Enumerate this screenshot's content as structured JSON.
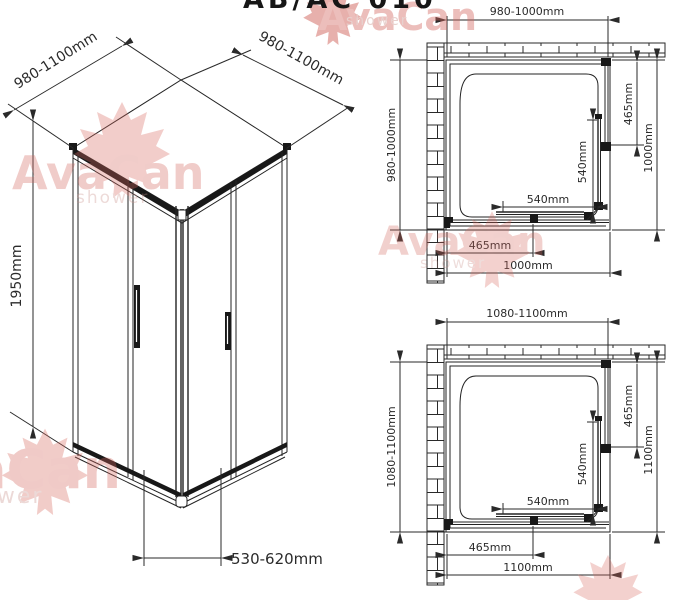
{
  "title_partial": "AB/AC 010",
  "watermark": {
    "brand": "AvaCan",
    "sub": "shower"
  },
  "isometric": {
    "dim_top_left": "980-1100mm",
    "dim_top_right": "980-1100mm",
    "dim_height": "1950mm",
    "dim_entry_width": "530-620mm"
  },
  "plans": [
    {
      "dim_top": "980-1000mm",
      "dim_left": "980-1000mm",
      "dim_right_inner": "465mm",
      "dim_right_outer": "1000mm",
      "dim_inner_vertical": "540mm",
      "dim_inner_horizontal": "540mm",
      "dim_bottom_inner": "465mm",
      "dim_bottom_outer": "1000mm"
    },
    {
      "dim_top": "1080-1100mm",
      "dim_left": "1080-1100mm",
      "dim_right_inner": "465mm",
      "dim_right_outer": "1100mm",
      "dim_inner_vertical": "540mm",
      "dim_inner_horizontal": "540mm",
      "dim_bottom_inner": "465mm",
      "dim_bottom_outer": "1100mm"
    }
  ],
  "colors": {
    "line": "#232323",
    "dim_text": "#2b2b2b",
    "watermark": "#d96b61",
    "title": "#161616"
  }
}
